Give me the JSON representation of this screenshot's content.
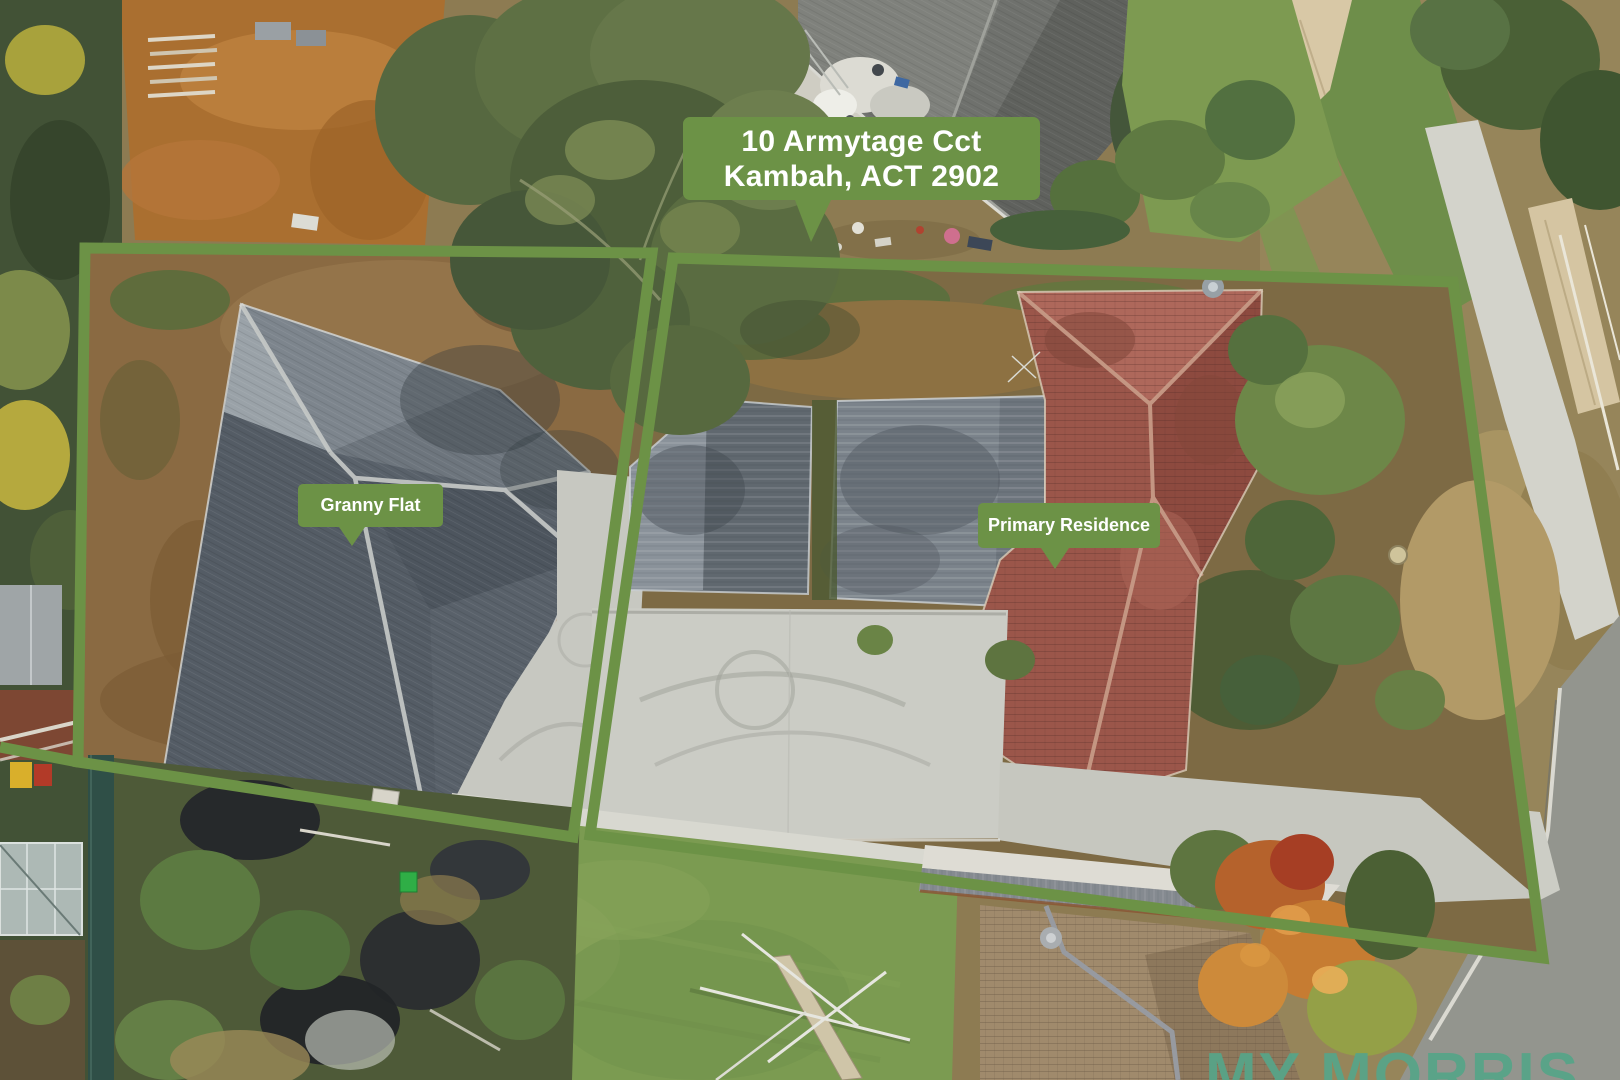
{
  "photo": {
    "kind": "aerial-drone-photo-of-property",
    "colors": {
      "overlay_green": "#6c9246",
      "label_text": "#ffffff",
      "watermark_teal": "#58a488"
    }
  },
  "callouts": {
    "address": {
      "line1": "10 Armytage Cct",
      "line2": "Kambah, ACT 2902"
    },
    "granny_flat": "Granny Flat",
    "primary_residence": "Primary Residence"
  },
  "watermark": "MY MORRIS"
}
